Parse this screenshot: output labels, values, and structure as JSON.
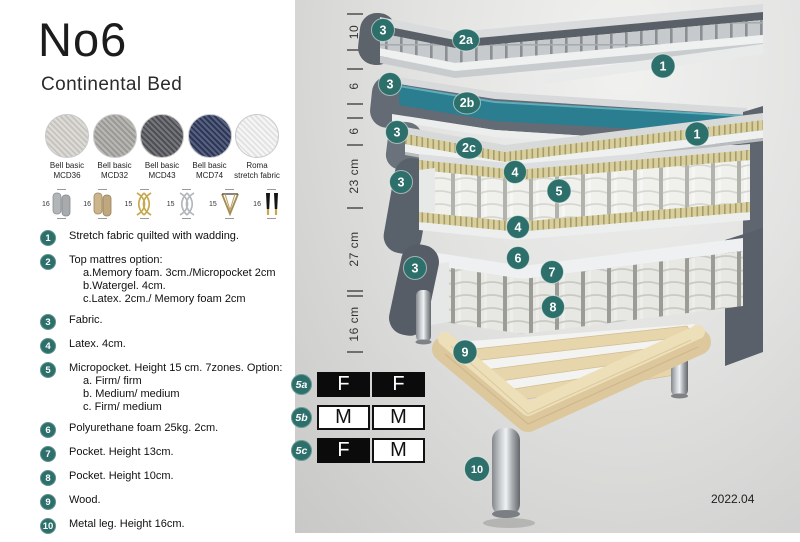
{
  "header": {
    "title": "No6",
    "subtitle": "Continental Bed"
  },
  "fabrics": [
    {
      "name": "Bell basic",
      "code": "MCD36",
      "color": "#d6d3cd"
    },
    {
      "name": "Bell basic",
      "code": "MCD32",
      "color": "#a6a5a1"
    },
    {
      "name": "Bell basic",
      "code": "MCD43",
      "color": "#54555a"
    },
    {
      "name": "Bell basic",
      "code": "MCD74",
      "color": "#2f3a5e"
    },
    {
      "name": "Roma",
      "code": "stretch fabric",
      "color": "#f4f4f4"
    }
  ],
  "legs": [
    {
      "height": "16",
      "style": "cylinder-gray"
    },
    {
      "height": "16",
      "style": "cylinder-wood"
    },
    {
      "height": "15",
      "style": "twist-gold"
    },
    {
      "height": "15",
      "style": "twist-silver"
    },
    {
      "height": "15",
      "style": "hairpin-gold"
    },
    {
      "height": "16",
      "style": "tapered-black-gold"
    }
  ],
  "spec_list": [
    {
      "num": "1",
      "text": "Stretch fabric quilted with wadding."
    },
    {
      "num": "2",
      "text": "Top mattres option:",
      "subs": [
        "a.Memory foam. 3cm./Micropocket 2cm",
        "b.Watergel. 4cm.",
        "c.Latex. 2cm./ Memory foam 2cm"
      ]
    },
    {
      "num": "3",
      "text": "Fabric."
    },
    {
      "num": "4",
      "text": "Latex. 4cm."
    },
    {
      "num": "5",
      "text": "Micropocket. Height 15 cm. 7zones. Option:",
      "subs": [
        "a. Firm/ firm",
        "b. Medium/ medium",
        "c. Firm/ medium"
      ]
    },
    {
      "num": "6",
      "text": "Polyurethane foam 25kg. 2cm."
    },
    {
      "num": "7",
      "text": "Pocket. Height 13cm."
    },
    {
      "num": "8",
      "text": "Pocket. Height 10cm."
    },
    {
      "num": "9",
      "text": "Wood."
    },
    {
      "num": "10",
      "text": "Metal leg. Height 16cm."
    }
  ],
  "diagram": {
    "accent_color": "#2d6f6a",
    "teal_layer_color": "#2b7e8f",
    "ruler": [
      "10",
      "6",
      "6",
      "23 cm",
      "27 cm",
      "16 cm"
    ],
    "badges": [
      "3",
      "2a",
      "1",
      "3",
      "2b",
      "1",
      "3",
      "2c",
      "3",
      "4",
      "5",
      "4",
      "3",
      "6",
      "7",
      "8",
      "9",
      "10"
    ]
  },
  "firmness": {
    "rows": [
      {
        "id": "5a",
        "cells": [
          "F",
          "F"
        ]
      },
      {
        "id": "5b",
        "cells": [
          "M",
          "M"
        ]
      },
      {
        "id": "5c",
        "cells": [
          "F",
          "M"
        ]
      }
    ]
  },
  "version": "2022.04"
}
